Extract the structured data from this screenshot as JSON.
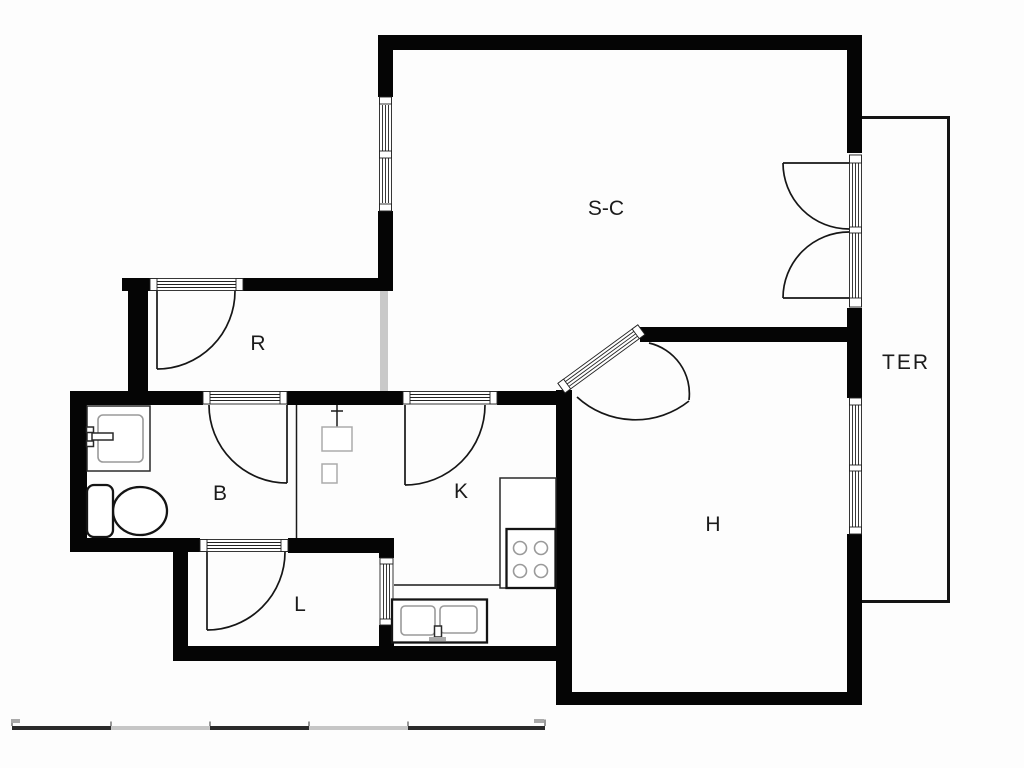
{
  "plan": {
    "title": "apartment-floor-plan",
    "rooms": [
      {
        "id": "sc",
        "label": "S-C"
      },
      {
        "id": "ter",
        "label": "TER"
      },
      {
        "id": "r",
        "label": "R"
      },
      {
        "id": "b",
        "label": "B"
      },
      {
        "id": "k",
        "label": "K"
      },
      {
        "id": "l",
        "label": "L"
      },
      {
        "id": "h",
        "label": "H"
      }
    ],
    "fixtures": [
      "bathroom-sink",
      "toilet",
      "water-heater",
      "closet-shaft",
      "kitchen-counter",
      "stove-4-burners",
      "kitchen-double-sink",
      "french-doors",
      "diagonal-glazed-door",
      "windows",
      "door-swings"
    ],
    "colors": {
      "wall": "#050505",
      "line": "#161616",
      "fixture_gray": "#9a9a9a",
      "partition_gray": "#c9c9c9",
      "background": "#fdfdfd",
      "scale_dark": "#2a2a2a",
      "scale_light": "#c6c6c6"
    },
    "scale_bar": {
      "segments": 5
    }
  }
}
